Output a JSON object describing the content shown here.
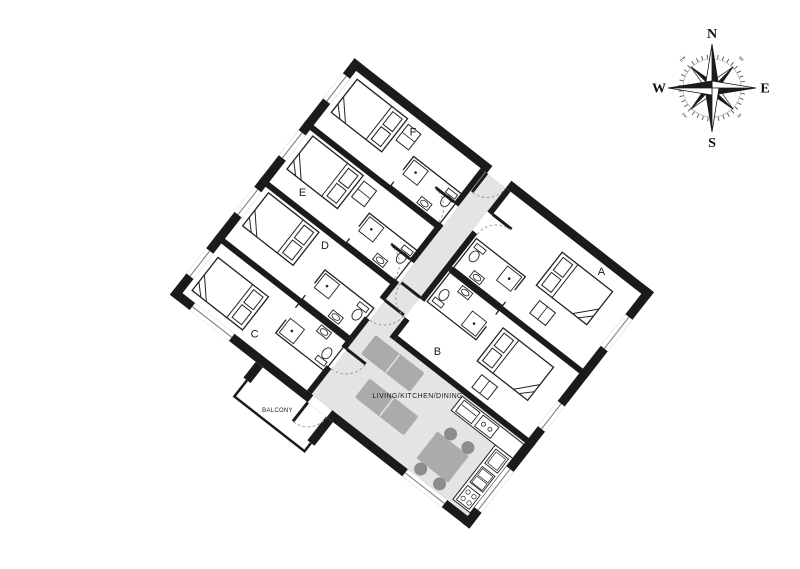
{
  "floorplan": {
    "rotation_deg": 38,
    "colors": {
      "wall": "#1b1b1b",
      "circulation_fill": "#e4e4e4",
      "sofa_fill": "#ababab",
      "table_fill": "#ababab",
      "chair_fill": "#8d8d8d"
    },
    "rooms": [
      {
        "id": "A",
        "label": "A"
      },
      {
        "id": "B",
        "label": "B"
      },
      {
        "id": "C",
        "label": "C"
      },
      {
        "id": "D",
        "label": "D"
      },
      {
        "id": "E",
        "label": "E"
      },
      {
        "id": "F",
        "label": "F"
      }
    ],
    "living_area_label": "LIVING/KITCHEN/DINING",
    "balcony_label": "BALCONY"
  },
  "compass": {
    "n": "N",
    "e": "E",
    "s": "S",
    "w": "W",
    "nw": "nw",
    "ne": "ne",
    "sw": "sw",
    "se": "se"
  }
}
